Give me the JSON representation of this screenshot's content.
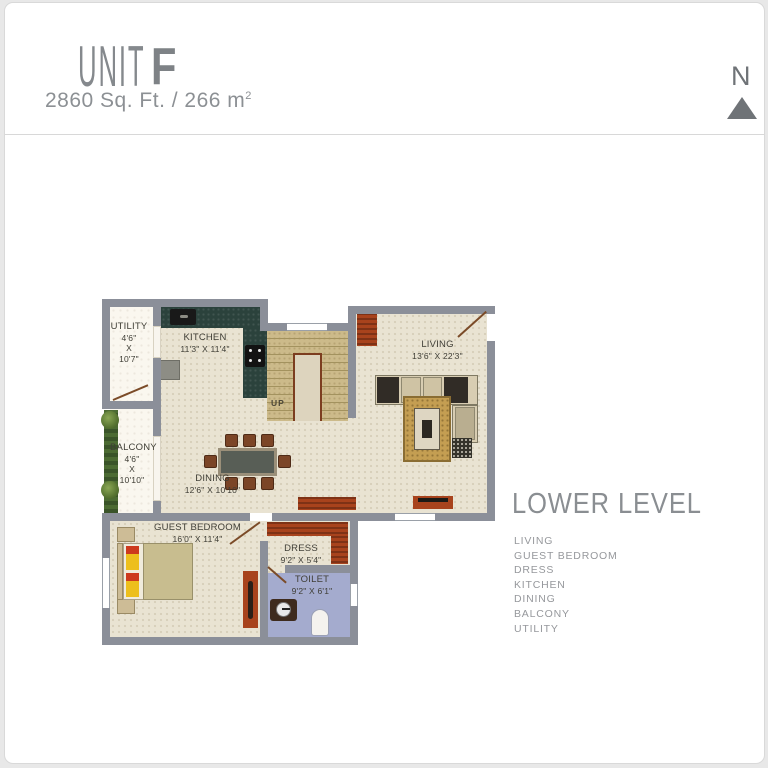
{
  "header": {
    "title": "UNIT",
    "unit_letter": "F",
    "area": "2860 Sq. Ft. / 266 m",
    "area_sup": "2"
  },
  "compass": {
    "label": "N"
  },
  "plan": {
    "rooms": {
      "utility": {
        "name": "UTILITY",
        "l1": "4'6\"",
        "l2": "X",
        "l3": "10'7\""
      },
      "kitchen": {
        "name": "KITCHEN",
        "dims": "11'3\" X 11'4\""
      },
      "living": {
        "name": "LIVING",
        "dims": "13'6\" X 22'3\""
      },
      "balcony": {
        "name": "BALCONY",
        "l1": "4'6\"",
        "l2": "X",
        "l3": "10'10\""
      },
      "dining": {
        "name": "DINING",
        "dims": "12'6\" X 10'10\""
      },
      "guest_bedroom": {
        "name": "GUEST BEDROOM",
        "dims": "16'0\" X 11'4\""
      },
      "dress": {
        "name": "DRESS",
        "dims": "9'2\" X 5'4\""
      },
      "toilet": {
        "name": "TOILET",
        "dims": "9'2\" X 6'1\""
      }
    },
    "stairs": {
      "label": "UP"
    }
  },
  "legend": {
    "heading": "LOWER LEVEL",
    "items": [
      "LIVING",
      "GUEST BEDROOM",
      "DRESS",
      "KITCHEN",
      "DINING",
      "BALCONY",
      "UTILITY"
    ]
  },
  "colors": {
    "wall": "#8b8f99",
    "floor_beige": "#e9e3d2",
    "counter_green": "#2b423c",
    "stair_tan": "#ccba8a",
    "toilet_blue": "#a4abce",
    "accent_red": "#a8431d",
    "heading_gray": "#8a8e92"
  }
}
